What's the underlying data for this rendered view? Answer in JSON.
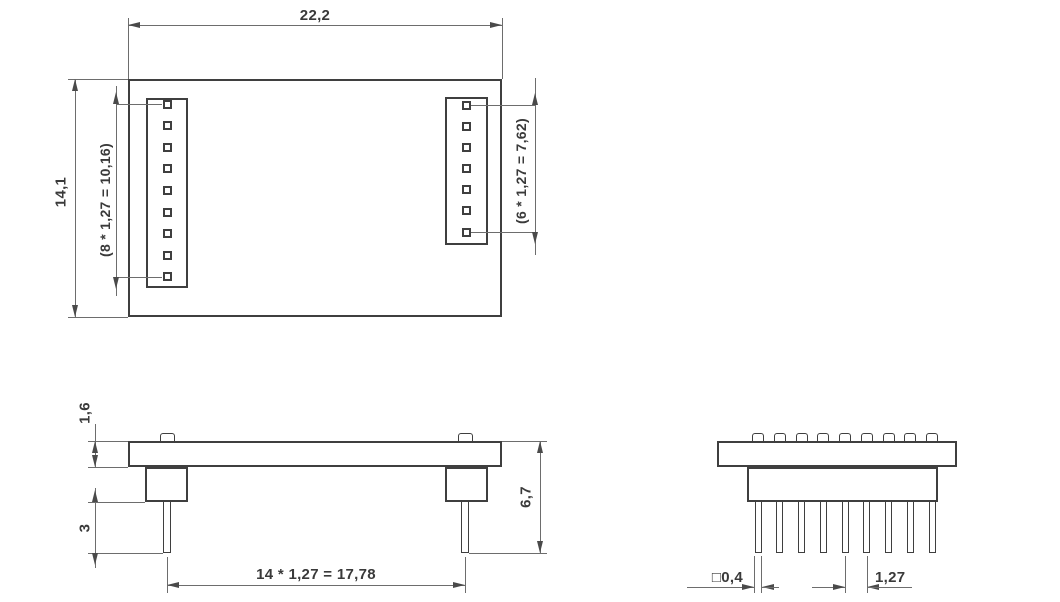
{
  "colors": {
    "object_line": "#3f3f3f",
    "dimension_line": "#6d6d6d",
    "text": "#3a3a3a",
    "background": "#ffffff"
  },
  "counts": {
    "left_column_pins": 9,
    "right_column_pins": 7,
    "end_view_bumps": 9,
    "end_view_pins": 9
  },
  "dimensions": {
    "board_width": "22,2",
    "board_height": "14,1",
    "left_column_span": "(8 * 1,27 = 10,16)",
    "right_column_span": "(6 * 1,27 = 7,62)",
    "board_thickness": "1,6",
    "pin_protrusion": "3",
    "overall_height": "6,7",
    "column_spacing": "14 * 1,27 = 17,78",
    "pin_cross_section": "□0,4",
    "pin_pitch": "1,27"
  }
}
